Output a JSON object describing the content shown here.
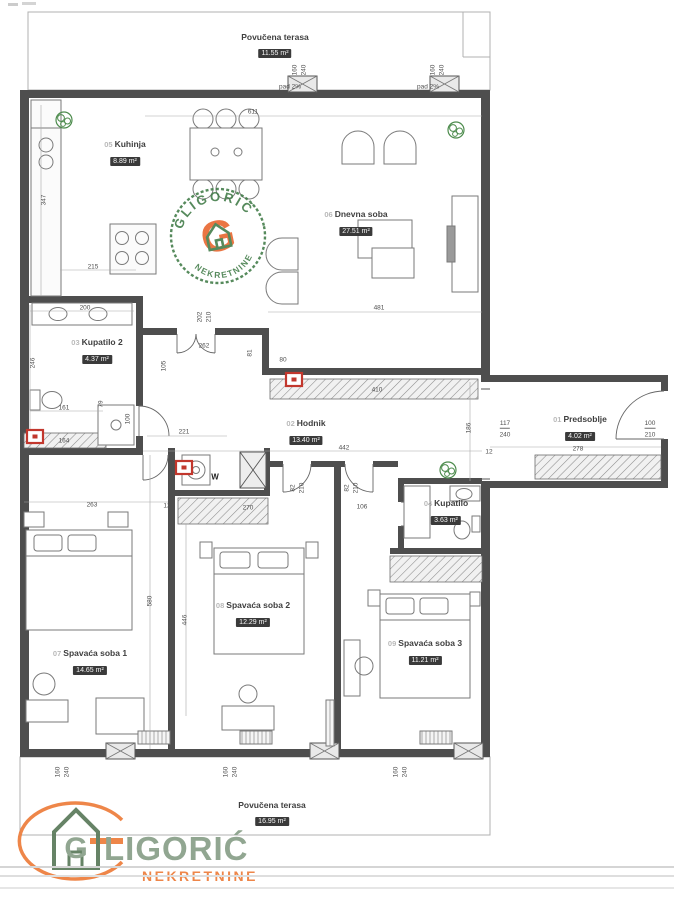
{
  "plan": {
    "rooms": [
      {
        "num": "",
        "name": "Povučena terasa",
        "area": "11.55 m²",
        "x": 275,
        "y": 32
      },
      {
        "num": "05",
        "name": "Kuhinja",
        "area": "8.89 m²",
        "x": 125,
        "y": 139
      },
      {
        "num": "06",
        "name": "Dnevna soba",
        "area": "27.51 m²",
        "x": 356,
        "y": 209
      },
      {
        "num": "03",
        "name": "Kupatilo 2",
        "area": "4.37 m²",
        "x": 97,
        "y": 337
      },
      {
        "num": "02",
        "name": "Hodnik",
        "area": "13.40 m²",
        "x": 306,
        "y": 418
      },
      {
        "num": "01",
        "name": "Predsoblje",
        "area": "4.02 m²",
        "x": 580,
        "y": 414
      },
      {
        "num": "04",
        "name": "Kupatilo",
        "area": "3.63 m²",
        "x": 446,
        "y": 498
      },
      {
        "num": "08",
        "name": "Spavaća soba 2",
        "area": "12.29 m²",
        "x": 253,
        "y": 600
      },
      {
        "num": "09",
        "name": "Spavaća soba 3",
        "area": "11.21 m²",
        "x": 425,
        "y": 638
      },
      {
        "num": "07",
        "name": "Spavaća soba 1",
        "area": "14.65 m²",
        "x": 90,
        "y": 648
      },
      {
        "num": "",
        "name": "Povučena terasa",
        "area": "16.95 m²",
        "x": 272,
        "y": 800
      }
    ],
    "dimensions": [
      {
        "t": "611",
        "x": 253,
        "y": 112
      },
      {
        "t": "160",
        "x": 295,
        "y": 70,
        "v": 1
      },
      {
        "t": "240",
        "x": 304,
        "y": 70,
        "v": 1
      },
      {
        "t": "pad 2%",
        "x": 290,
        "y": 87
      },
      {
        "t": "160",
        "x": 433,
        "y": 70,
        "v": 1
      },
      {
        "t": "240",
        "x": 442,
        "y": 70,
        "v": 1
      },
      {
        "t": "pad 2%",
        "x": 428,
        "y": 87
      },
      {
        "t": "347",
        "x": 44,
        "y": 200,
        "v": 1
      },
      {
        "t": "215",
        "x": 93,
        "y": 267
      },
      {
        "t": "200",
        "x": 85,
        "y": 308
      },
      {
        "t": "202",
        "x": 200,
        "y": 317,
        "v": 1
      },
      {
        "t": "210",
        "x": 209,
        "y": 317,
        "v": 1
      },
      {
        "t": "262",
        "x": 204,
        "y": 346
      },
      {
        "t": "481",
        "x": 379,
        "y": 308
      },
      {
        "t": "410",
        "x": 377,
        "y": 390
      },
      {
        "t": "105",
        "x": 164,
        "y": 366,
        "v": 1
      },
      {
        "t": "81",
        "x": 250,
        "y": 353,
        "v": 1
      },
      {
        "t": "80",
        "x": 283,
        "y": 360
      },
      {
        "t": "246",
        "x": 33,
        "y": 363,
        "v": 1
      },
      {
        "t": "161",
        "x": 64,
        "y": 408
      },
      {
        "t": "79",
        "x": 101,
        "y": 404,
        "v": 1
      },
      {
        "t": "164",
        "x": 64,
        "y": 441
      },
      {
        "t": "100",
        "x": 128,
        "y": 419,
        "v": 1
      },
      {
        "t": "221",
        "x": 184,
        "y": 432
      },
      {
        "t": "442",
        "x": 344,
        "y": 448
      },
      {
        "t": "186",
        "x": 469,
        "y": 428,
        "v": 1
      },
      {
        "t": "117",
        "x": 505,
        "y": 424,
        "u": 1
      },
      {
        "t": "240",
        "x": 505,
        "y": 435
      },
      {
        "t": "12",
        "x": 489,
        "y": 452
      },
      {
        "t": "278",
        "x": 578,
        "y": 449
      },
      {
        "t": "100",
        "x": 650,
        "y": 424,
        "u": 1
      },
      {
        "t": "210",
        "x": 650,
        "y": 435
      },
      {
        "t": "263",
        "x": 92,
        "y": 505
      },
      {
        "t": "12",
        "x": 167,
        "y": 506
      },
      {
        "t": "270",
        "x": 248,
        "y": 508
      },
      {
        "t": "82",
        "x": 293,
        "y": 488,
        "v": 1
      },
      {
        "t": "210",
        "x": 302,
        "y": 488,
        "v": 1
      },
      {
        "t": "82",
        "x": 347,
        "y": 488,
        "v": 1
      },
      {
        "t": "210",
        "x": 356,
        "y": 488,
        "v": 1
      },
      {
        "t": "106",
        "x": 362,
        "y": 507
      },
      {
        "t": "W",
        "x": 215,
        "y": 477,
        "b": 1
      },
      {
        "t": "580",
        "x": 150,
        "y": 601,
        "v": 1
      },
      {
        "t": "446",
        "x": 185,
        "y": 620,
        "v": 1
      },
      {
        "t": "160",
        "x": 58,
        "y": 772,
        "v": 1
      },
      {
        "t": "240",
        "x": 67,
        "y": 772,
        "v": 1
      },
      {
        "t": "160",
        "x": 226,
        "y": 772,
        "v": 1
      },
      {
        "t": "240",
        "x": 235,
        "y": 772,
        "v": 1
      },
      {
        "t": "160",
        "x": 396,
        "y": 772,
        "v": 1
      },
      {
        "t": "240",
        "x": 405,
        "y": 772,
        "v": 1
      }
    ]
  },
  "stamp": {
    "name": "GLIGORIĆ",
    "subtitle": "NEKRETNINE",
    "monogram": "G"
  },
  "watermark": {
    "monogram": "G",
    "name": "LIGORIĆ",
    "subtitle": "NEKRETNINE"
  },
  "colors": {
    "wall": "#4e4e4e",
    "stamp_green": "#3f7a46",
    "logo_green": "#8ca28c",
    "logo_orange": "#ee8040",
    "marker_red": "#c2372d",
    "plant_green": "#4c8b4c"
  }
}
